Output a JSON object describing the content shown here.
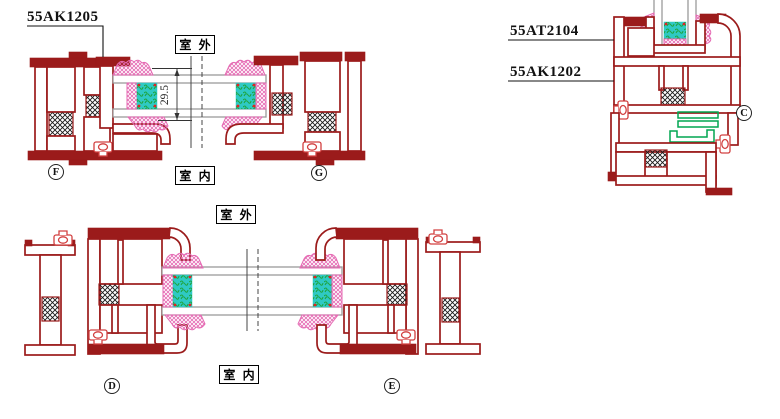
{
  "drawing": {
    "labels": {
      "top_left_part": "55AK1205",
      "right_part_upper": "55AT2104",
      "right_part_lower": "55AK1202"
    },
    "zones": {
      "outdoor_top": "室 外",
      "indoor_top": "室 内",
      "outdoor_bottom": "室 外",
      "indoor_bottom": "室 内"
    },
    "markers": {
      "f": "F",
      "g": "G",
      "c": "C",
      "d": "D",
      "e": "E"
    },
    "dimensions": {
      "glazing_thickness": "29.5"
    },
    "colors": {
      "profile": "#9b1b1b",
      "gasket": "#e56ab3",
      "glass": "#9a9a9a",
      "spacer": "#2fc9c4",
      "scribble": "#1ea43c",
      "thermal": "#1a1a1a",
      "hardware": "#00a651",
      "clip": "#d24040",
      "dot": "#e02424"
    }
  }
}
